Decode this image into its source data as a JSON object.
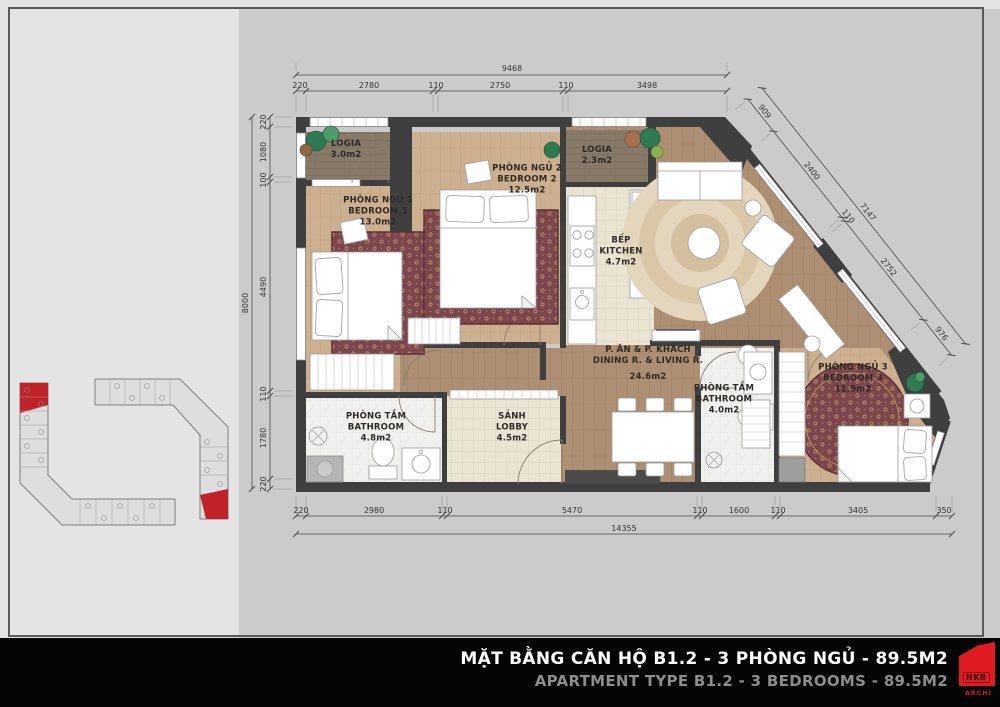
{
  "title_bar": {
    "title_vi": "MẶT BẰNG CĂN HỘ B1.2 - 3 PHÒNG NGỦ - 89.5M2",
    "title_en": "APARTMENT TYPE B1.2 - 3 BEDROOMS - 89.5M2",
    "logo_text": "NKB",
    "logo_sub": "ARCHI",
    "accent_color": "#e01b22"
  },
  "rooms": {
    "logia1": {
      "name_vi": "LOGIA",
      "area": "3.0m2"
    },
    "bedroom1": {
      "name_vi": "PHÒNG NGỦ 1",
      "name_en": "BEDROOM 1",
      "area": "13.0m2"
    },
    "bedroom2": {
      "name_vi": "PHÒNG NGỦ 2",
      "name_en": "BEDROOM 2",
      "area": "12.5m2"
    },
    "logia2": {
      "name_vi": "LOGIA",
      "area": "2.3m2"
    },
    "kitchen": {
      "name_vi": "BẾP",
      "name_en": "KITCHEN",
      "area": "4.7m2"
    },
    "living": {
      "name_vi": "P. ĂN & P. KHÁCH",
      "name_en": "DINING R. & LIVING R.",
      "area": "24.6m2"
    },
    "bathroom1": {
      "name_vi": "PHÒNG TẮM",
      "name_en": "BATHROOM",
      "area": "4.8m2"
    },
    "lobby": {
      "name_vi": "SẢNH",
      "name_en": "LOBBY",
      "area": "4.5m2"
    },
    "bathroom2": {
      "name_vi": "PHÒNG TẮM",
      "name_en": "BATHROOM",
      "area": "4.0m2"
    },
    "bedroom3": {
      "name_vi": "PHÒNG NGỦ 3",
      "name_en": "BEDROOM 3",
      "area": "11.9m2"
    }
  },
  "dimensions": {
    "top": {
      "total": "9468",
      "segments": [
        "220",
        "2780",
        "110",
        "2750",
        "110",
        "3498"
      ]
    },
    "left": {
      "total": "8000",
      "segments": [
        "220",
        "1080",
        "100",
        "4490",
        "110",
        "1780",
        "220"
      ]
    },
    "bottom": {
      "total": "14355",
      "segments": [
        "220",
        "2980",
        "110",
        "5470",
        "110",
        "1600",
        "110",
        "3405",
        "350"
      ]
    },
    "diagonal": {
      "total": "7147",
      "segments": [
        "909",
        "2400",
        "110",
        "2752",
        "976"
      ]
    }
  }
}
